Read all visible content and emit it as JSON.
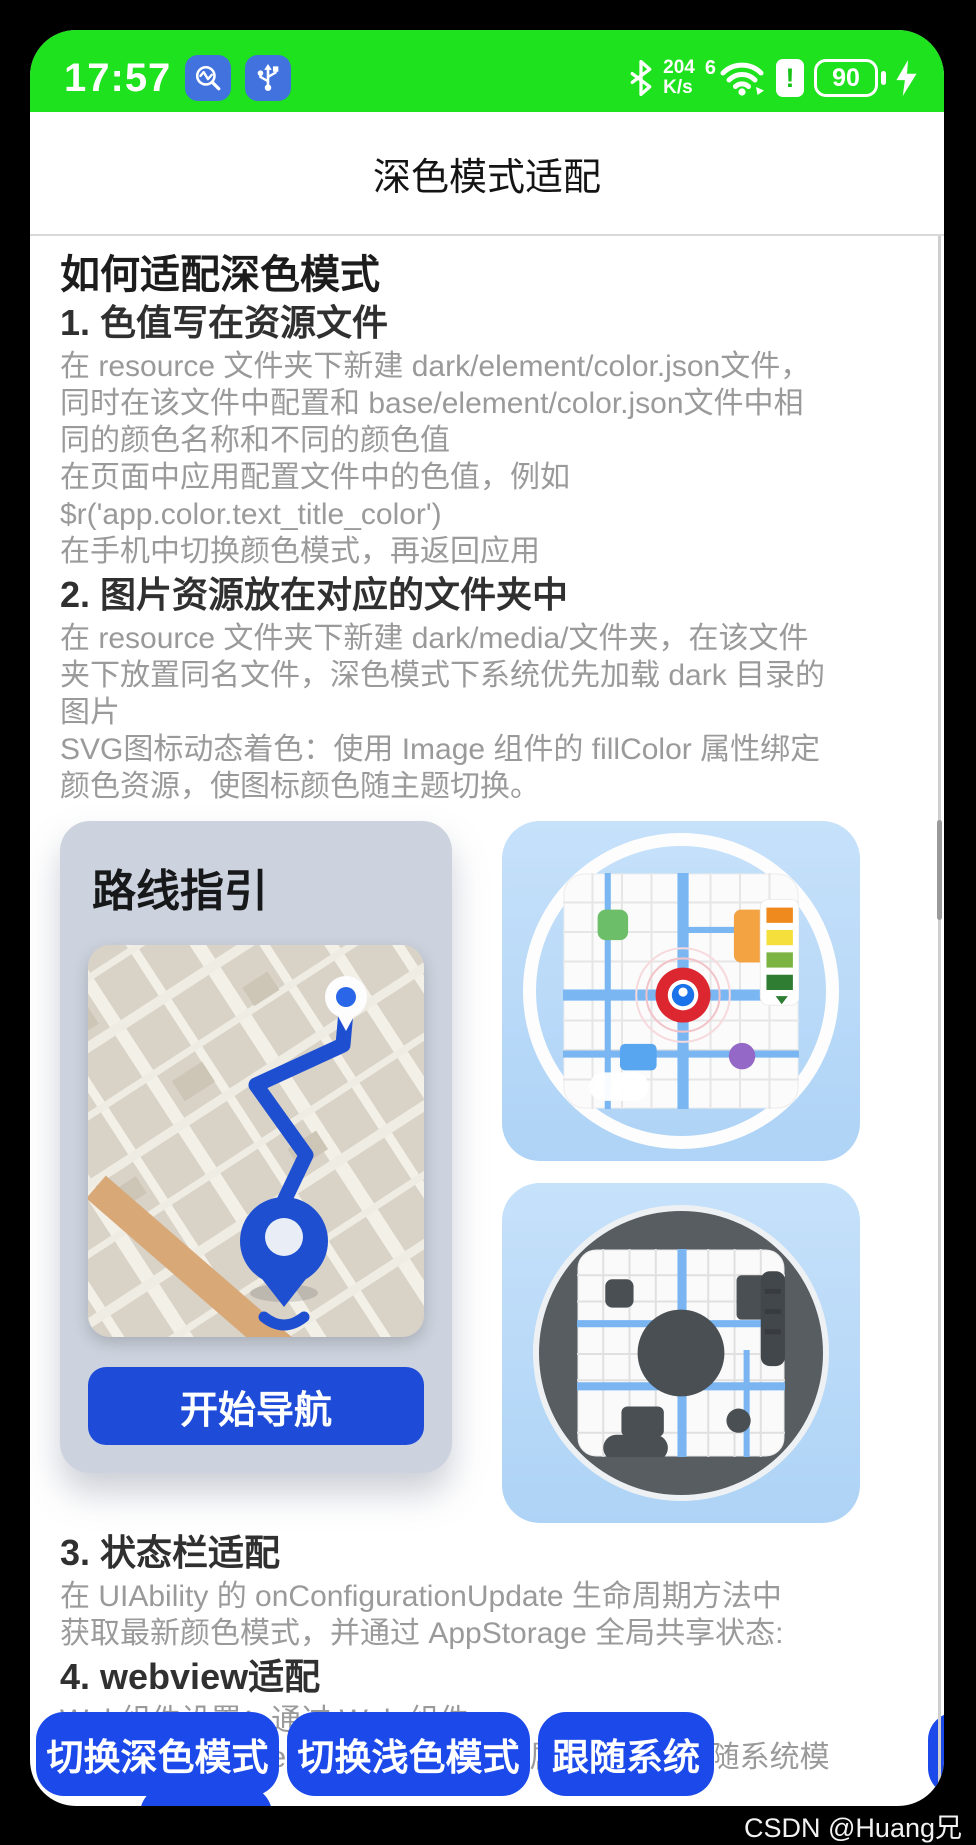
{
  "status_bar": {
    "time": "17:57",
    "net_speed": "204",
    "net_speed_unit": "K/s",
    "wifi_badge": "6",
    "battery": "90",
    "icons": [
      "app-monitor-icon",
      "usb-icon",
      "bluetooth-icon",
      "wifi-icon",
      "sim-alert-icon",
      "battery-icon",
      "charging-bolt-icon"
    ]
  },
  "title_bar": {
    "title": "深色模式适配"
  },
  "article": {
    "heading": "如何适配深色模式",
    "sections": [
      {
        "heading": "1. 色值写在资源文件",
        "body": "在 resource 文件夹下新建 dark/element/color.json文件，\n同时在该文件中配置和 base/element/color.json文件中相\n同的颜色名称和不同的颜色值\n在页面中应用配置文件中的色值，例如\n$r('app.color.text_title_color')\n在手机中切换颜色模式，再返回应用"
      },
      {
        "heading": "2. 图片资源放在对应的文件夹中",
        "body": "在 resource 文件夹下新建 dark/media/文件夹，在该文件\n夹下放置同名文件，深色模式下系统优先加载 dark 目录的\n图片\nSVG图标动态着色：使用 Image 组件的 fillColor 属性绑定\n颜色资源，使图标颜色随主题切换。"
      },
      {
        "heading": "3. 状态栏适配",
        "body": "在 UIAbility 的 onConfigurationUpdate 生命周期方法中\n获取最新颜色模式，并通过 AppStorage 全局共享状态:"
      },
      {
        "heading": "4. webview适配",
        "body": "Web组件设置：通过 Web 组件\n的 darkMode(WebDarkMode.Auto) 属性可配置跟随系统模"
      }
    ],
    "route_card": {
      "title": "路线指引",
      "button_label": "开始导航"
    }
  },
  "footer": {
    "buttons": [
      {
        "label": "切换深色模式"
      },
      {
        "label": "切换浅色模式"
      },
      {
        "label": "跟随系统"
      }
    ]
  },
  "watermark": "CSDN @Huang兄",
  "colors": {
    "status_bar_green": "#1de21d",
    "badge_blue": "#4272dd",
    "footer_button_blue": "#1c49ea",
    "route_blue": "#1d4fd0",
    "nav_button_blue": "#1e4cd8",
    "route_card_gray": "#cdd3de",
    "icon_card_light_blue": "#b8d9f8",
    "dark_circle_gray": "#585d62",
    "body_text_gray": "#9a9a9a"
  }
}
